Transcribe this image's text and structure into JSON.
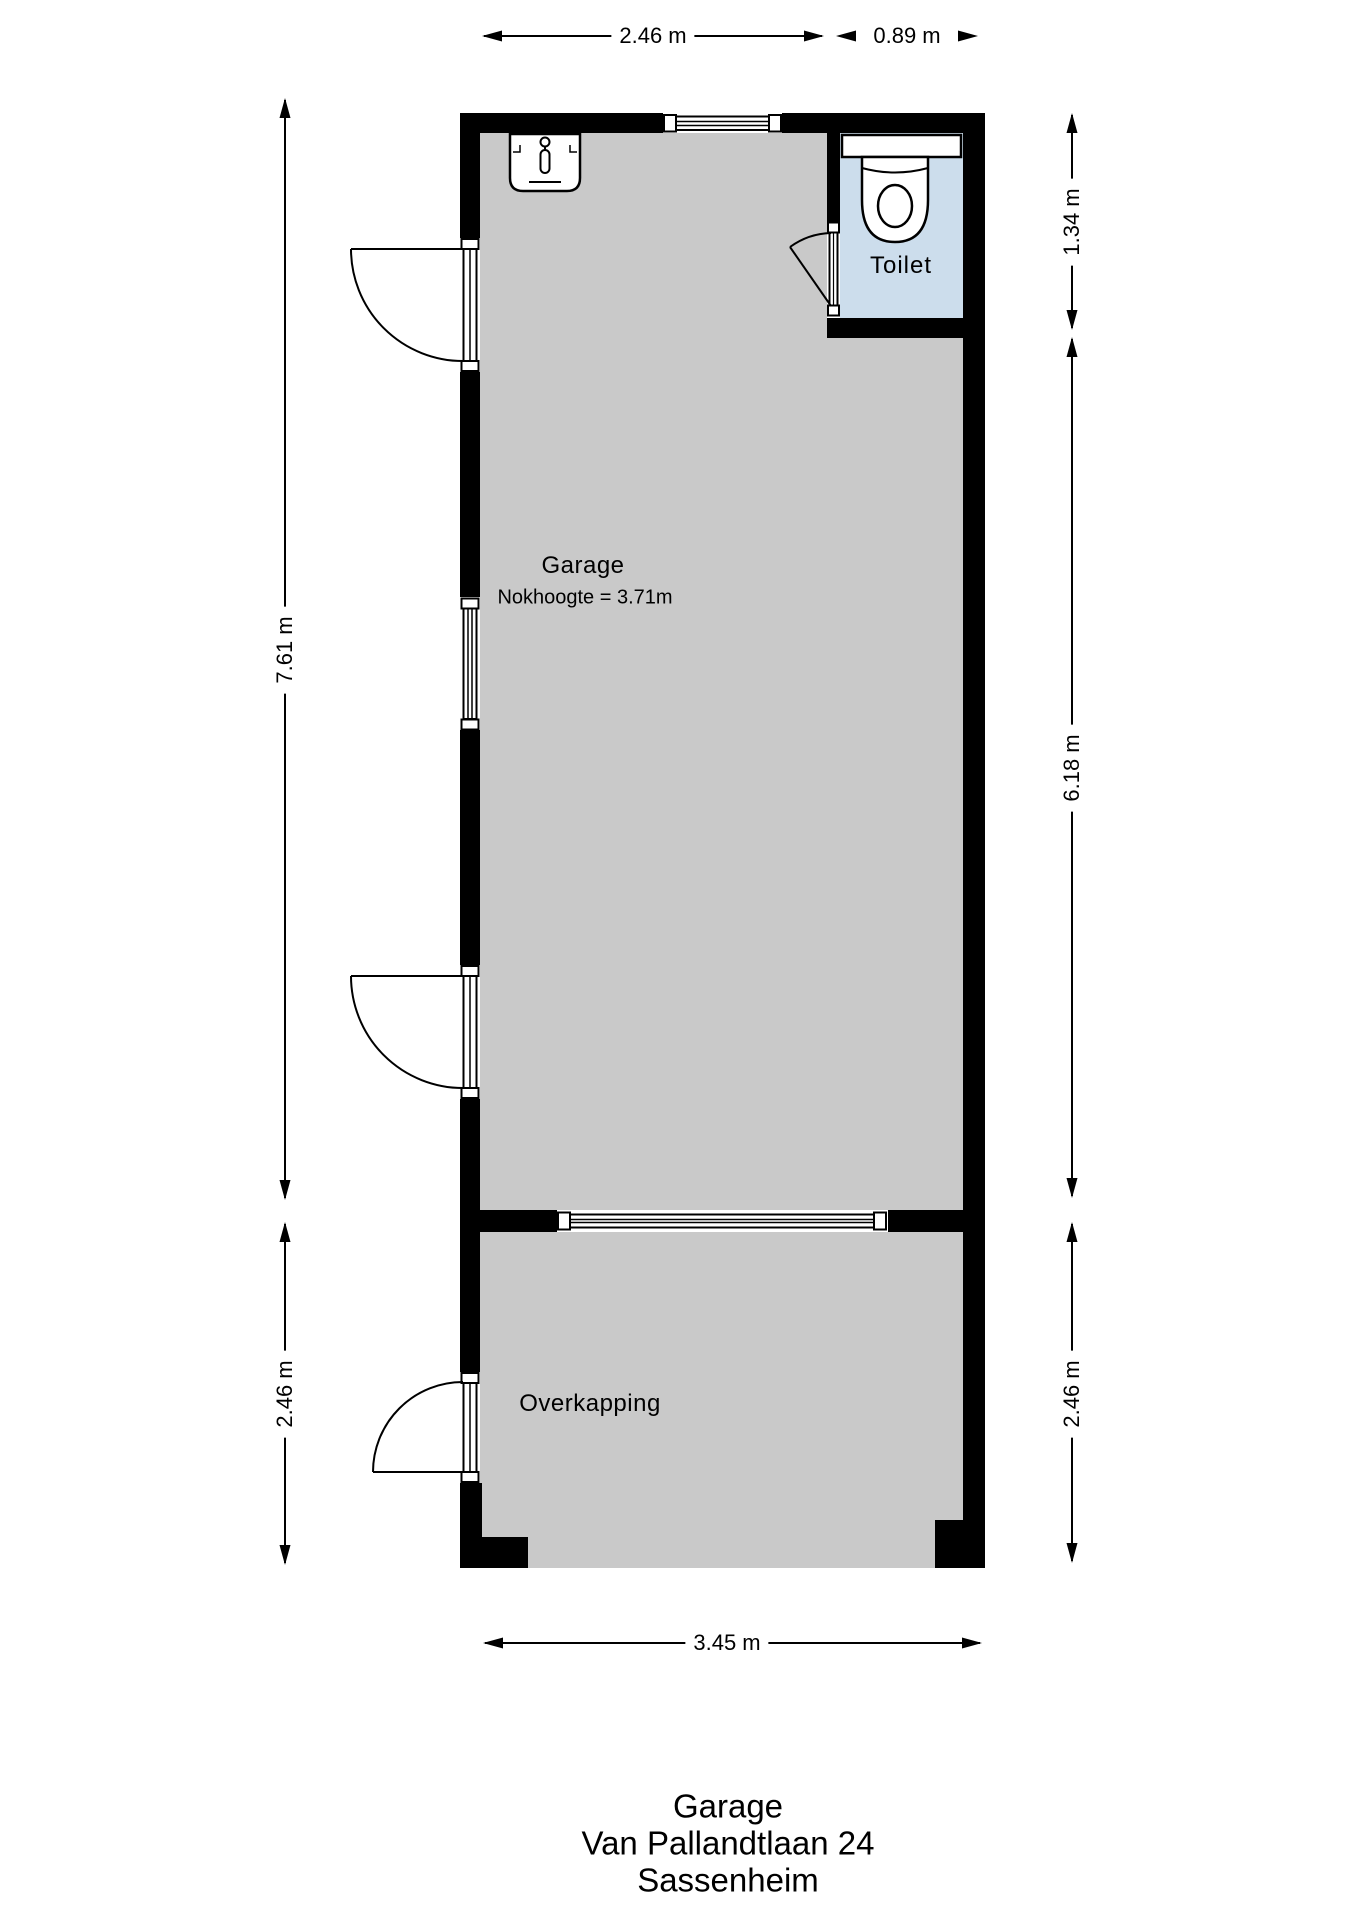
{
  "rooms": {
    "garage": {
      "label": "Garage",
      "note": "Nokhoogte = 3.71m"
    },
    "toilet": {
      "label": "Toilet"
    },
    "overkapping": {
      "label": "Overkapping"
    }
  },
  "dimensions": {
    "top_garage_width": "2.46 m",
    "top_toilet_width": "0.89 m",
    "left_garage_depth": "7.61 m",
    "left_overkapping_depth": "2.46 m",
    "right_toilet_depth": "1.34 m",
    "right_garage_depth": "6.18 m",
    "right_overkapping_depth": "2.46 m",
    "bottom_width": "3.45 m"
  },
  "title": {
    "line1": "Garage",
    "line2": "Van Pallandtlaan 24",
    "line3": "Sassenheim"
  },
  "colors": {
    "wall": "#000000",
    "garage_floor": "#c9c9c9",
    "overkapping_floor": "#c9c9c9",
    "toilet_floor": "#ccddec",
    "line": "#000000",
    "background": "#ffffff"
  }
}
